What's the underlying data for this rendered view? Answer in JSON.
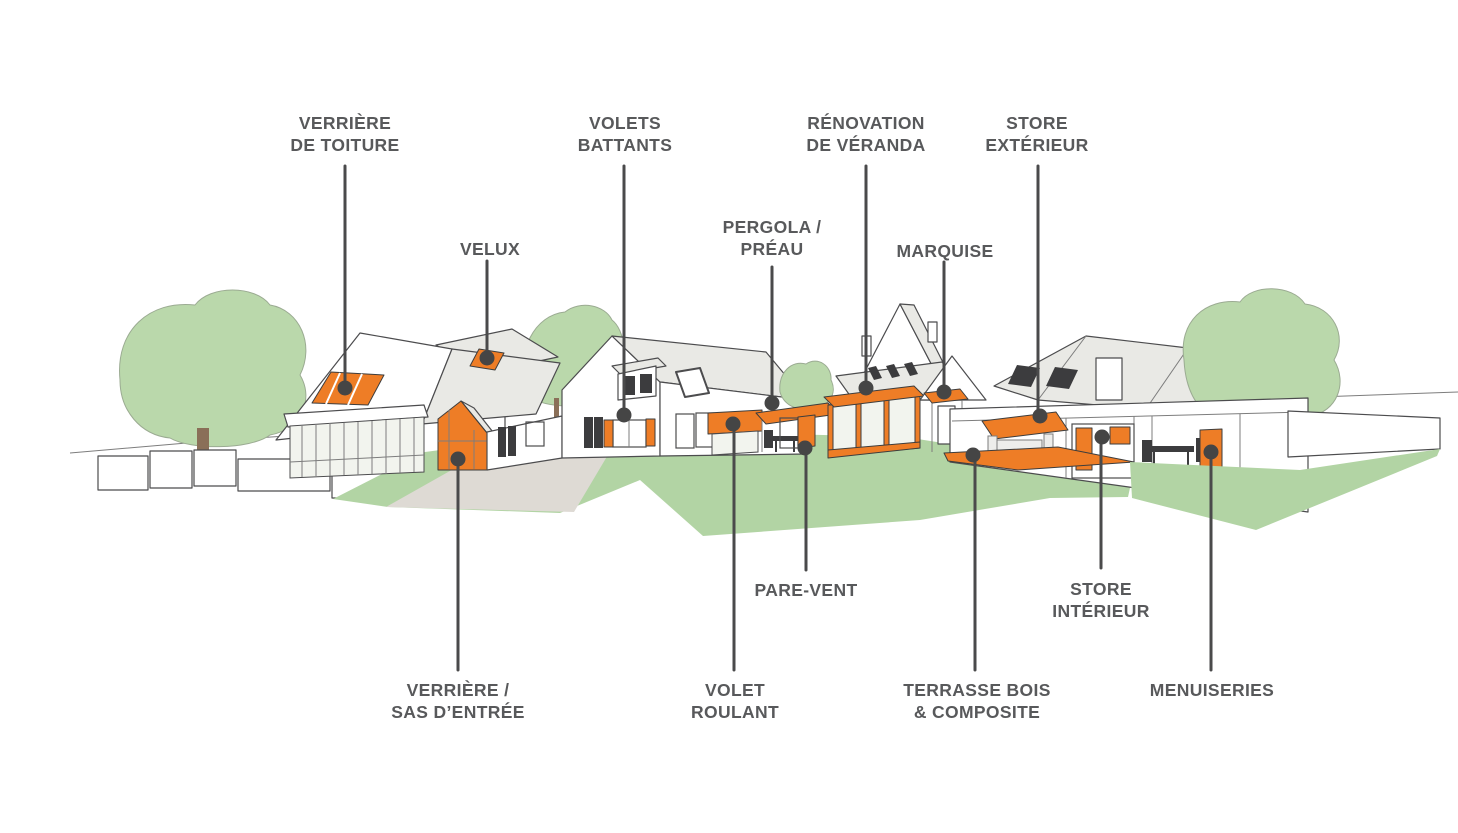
{
  "colors": {
    "background": "#ffffff",
    "label_text": "#58595b",
    "leader_line": "#4a4a4b",
    "anchor_dot": "#454545",
    "accent_orange": "#ee7d26",
    "tree_green": "#bad8ab",
    "grass_green": "#b2d4a4",
    "path_gray": "#dedad4",
    "roof_gray": "#e9e9e5",
    "outline_gray": "#4c4c4e"
  },
  "labels": [
    {
      "id": "verriere-de-toiture",
      "lines": [
        "VERRIÈRE",
        "DE TOITURE"
      ]
    },
    {
      "id": "velux",
      "lines": [
        "VELUX"
      ]
    },
    {
      "id": "volets-battants",
      "lines": [
        "VOLETS",
        "BATTANTS"
      ]
    },
    {
      "id": "pergola-preau",
      "lines": [
        "PERGOLA /",
        "PRÉAU"
      ]
    },
    {
      "id": "renovation-de-veranda",
      "lines": [
        "RÉNOVATION",
        "DE VÉRANDA"
      ]
    },
    {
      "id": "marquise",
      "lines": [
        "MARQUISE"
      ]
    },
    {
      "id": "store-exterieur",
      "lines": [
        "STORE",
        "EXTÉRIEUR"
      ]
    },
    {
      "id": "verriere-sas-entree",
      "lines": [
        "VERRIÈRE /",
        "SAS D’ENTRÉE"
      ]
    },
    {
      "id": "volet-roulant",
      "lines": [
        "VOLET",
        "ROULANT"
      ]
    },
    {
      "id": "pare-vent",
      "lines": [
        "PARE-VENT"
      ]
    },
    {
      "id": "terrasse-bois-composite",
      "lines": [
        "TERRASSE BOIS",
        "& COMPOSITE"
      ]
    },
    {
      "id": "store-interieur",
      "lines": [
        "STORE",
        "INTÉRIEUR"
      ]
    },
    {
      "id": "menuiseries",
      "lines": [
        "MENUISERIES"
      ]
    }
  ]
}
